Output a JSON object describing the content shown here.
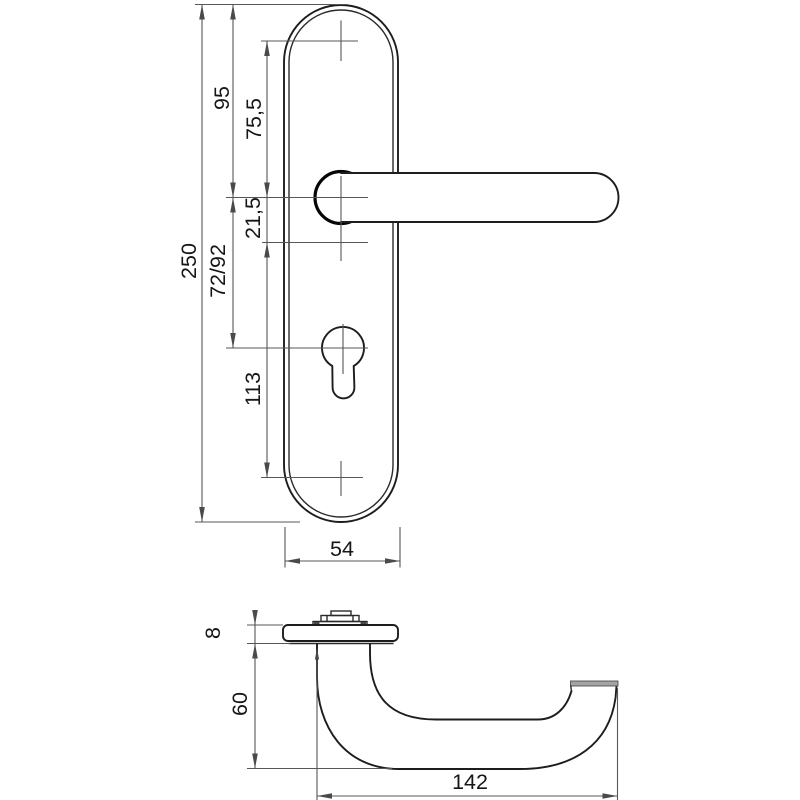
{
  "drawing": {
    "type": "technical-dimension-drawing",
    "subject": "door-handle-with-long-backplate",
    "front_view": {
      "dimensions": {
        "overall_length": "250",
        "plate_top_to_handle_center": "95",
        "top_hole_to_handle_center": "75,5",
        "handle_center_to_lower_hole": "21,5",
        "handle_center_to_cylinder": "72/92",
        "lower_hole_to_bottom_hole": "113",
        "plate_width": "54"
      }
    },
    "side_view": {
      "dimensions": {
        "rose_thickness": "8",
        "handle_projection": "60",
        "handle_length": "142"
      }
    },
    "colors": {
      "background": "#ffffff",
      "object_line": "#1d1d1d",
      "dimension_line": "#575757",
      "label_text": "#161616",
      "grip_end_face": "#a3a3a3"
    }
  }
}
